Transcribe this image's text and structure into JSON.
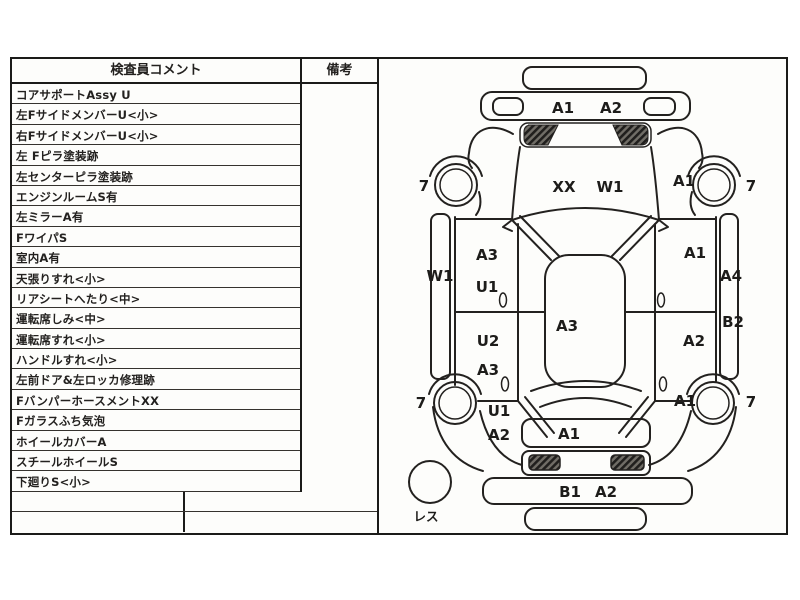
{
  "sheet": {
    "header": {
      "comments": "検査員コメント",
      "remarks": "備考"
    },
    "comment_rows": [
      "コアサポートAssy U",
      "左FサイドメンバーU<小>",
      "右FサイドメンバーU<小>",
      "左 Fピラ塗装跡",
      "左センターピラ塗装跡",
      "エンジンルームS有",
      "左ミラーA有",
      "FワイパS",
      "室内A有",
      "天張りすれ<小>",
      "リアシートへたり<中>",
      "運転席しみ<中>",
      "運転席すれ<小>",
      "ハンドルすれ<小>",
      "左前ドア&左ロッカ修理跡",
      "FバンパーホースメントXX",
      "Fガラスふち気泡",
      "ホイールカバーA",
      "スチールホイールS",
      "下廻りS<小>"
    ]
  },
  "diagram": {
    "front_bumper_left": "A1",
    "front_bumper_right": "A2",
    "hood_left": "XX",
    "hood_right": "W1",
    "front_left_wheel": "7",
    "front_right_wheel": "7",
    "rear_left_wheel": "7",
    "rear_right_wheel": "7",
    "front_right_fender": "A1",
    "left_rocker": "W1",
    "right_sill_upper": "A4",
    "right_sill_lower": "B2",
    "left_front_door_upper": "A3",
    "left_front_door_lower": "U1",
    "left_rear_door_upper": "U2",
    "left_rear_door_lower": "A3",
    "roof": "A3",
    "right_front_door": "A1",
    "right_rear_door": "A2",
    "left_quarter_upper": "U1",
    "left_quarter_lower": "A2",
    "rear_right_fender": "A1",
    "trunk": "A1",
    "rear_bumper_left": "B1",
    "rear_bumper_right": "A2",
    "spare_tire": "レス"
  }
}
